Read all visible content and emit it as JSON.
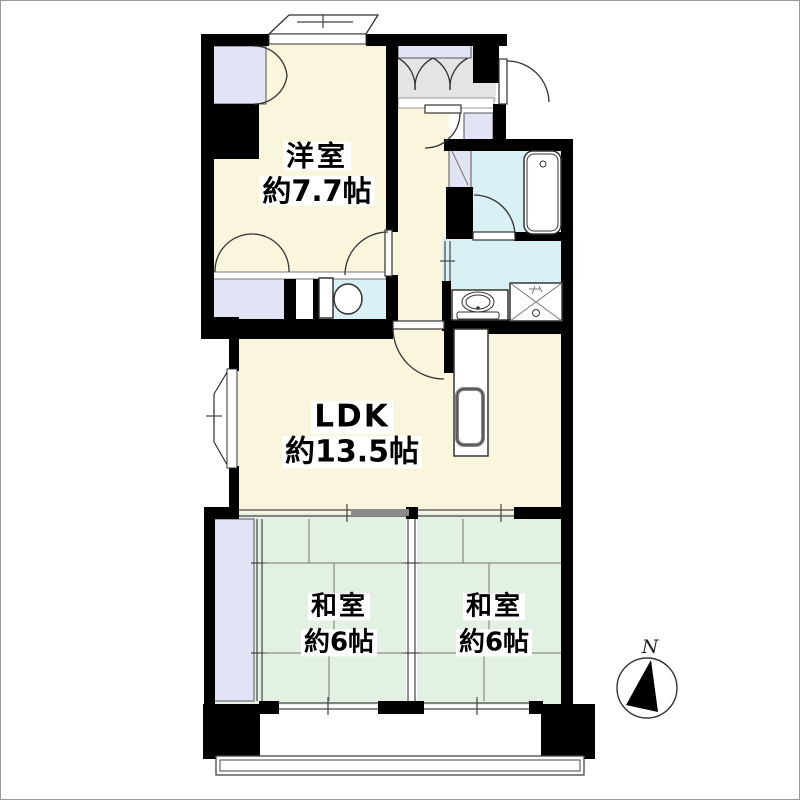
{
  "image_type": "apartment-floor-plan",
  "rooms": {
    "western_room": {
      "name": "洋室",
      "size": "約7.7帖"
    },
    "ldk": {
      "name": "LDK",
      "size": "約13.5帖"
    },
    "japanese_room_left": {
      "name": "和室",
      "size": "約6帖"
    },
    "japanese_room_right": {
      "name": "和室",
      "size": "約6帖"
    }
  },
  "compass": {
    "north_label": "N"
  },
  "colors": {
    "room-cream": "#FAF6DE",
    "tatami-green": "#E2F1E1",
    "wet-area-cyan": "#D9F1F4",
    "closet-lavender": "#E3E3F6",
    "entrance-gray": "#E4E4E4",
    "wall-black": "#000000",
    "line-gray": "#444444"
  }
}
